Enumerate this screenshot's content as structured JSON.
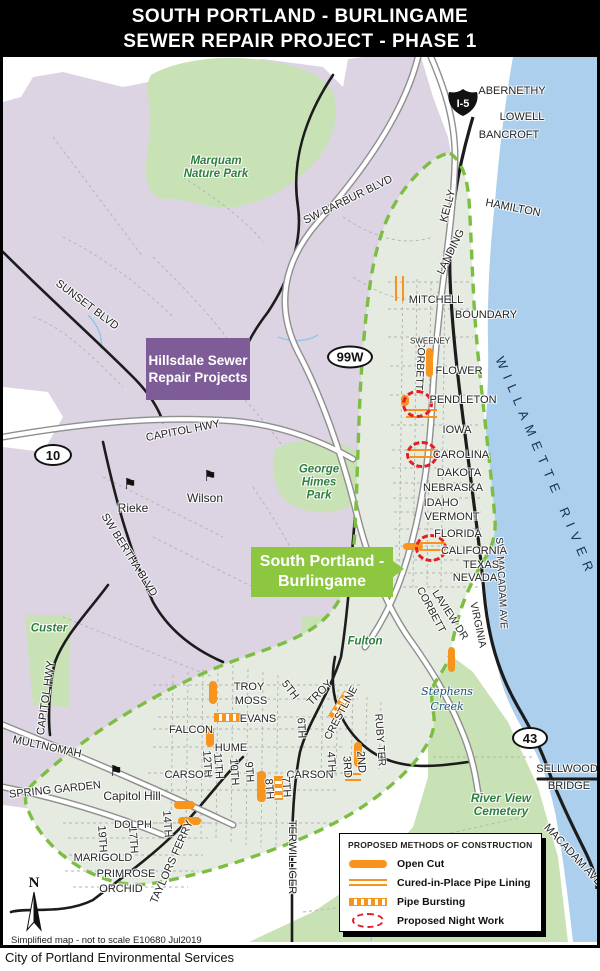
{
  "title": {
    "line1": "SOUTH PORTLAND - BURLINGAME",
    "line2": "SEWER REPAIR PROJECT - PHASE 1"
  },
  "footer": {
    "note": "Simplified map - not to scale E10680 Jul2019",
    "credit": "City of Portland Environmental Services"
  },
  "compass": {
    "north": "N"
  },
  "shields": {
    "i5": "I-5",
    "w99": "99W",
    "h10": "10",
    "h43": "43"
  },
  "boxes": {
    "hillsdale": "Hillsdale Sewer Repair Projects",
    "burlingame": "South Portland - Burlingame"
  },
  "parks": {
    "marquam": "Marquam Nature Park",
    "himes": "George Himes Park",
    "custer": "Custer",
    "fulton": "Fulton",
    "cemetery": "River View Cemetery"
  },
  "water": {
    "river": "WILLAMETTE RIVER",
    "creek": "Stephens Creek"
  },
  "schools": {
    "rieke": "Rieke",
    "wilson": "Wilson",
    "capitol_hill": "Capitol Hill"
  },
  "roads": {
    "barbur": "SW BARBUR BLVD",
    "sunset": "SUNSET BLVD",
    "capitol_upper": "CAPITOL HWY",
    "capitol_left": "CAPITOL HWY",
    "bertha": "SW BERTHA BLVD",
    "multnomah": "MULTNOMAH",
    "spring_garden": "SPRING GARDEN",
    "taylors_ferry": "TAYLORS FERRY",
    "terwilliger": "TERWILLIGER",
    "kelly": "KELLY",
    "landing": "LANDING",
    "macadam_sw": "SW MACADAM AVE",
    "macadam": "MACADAM AVE",
    "sellwood1": "SELLWOOD",
    "sellwood2": "BRIDGE",
    "laview": "LAVIEW DR",
    "virginia": "VIRGINIA",
    "corbett_n": "CORBETT",
    "corbett_s": "CORBETT"
  },
  "streets": {
    "abernethy": "ABERNETHY",
    "lowell": "LOWELL",
    "bancroft": "BANCROFT",
    "hamilton": "HAMILTON",
    "mitchell": "MITCHELL",
    "boundary": "BOUNDARY",
    "sweeney": "SWEENEY",
    "flower": "FLOWER",
    "pendleton": "PENDLETON",
    "iowa": "IOWA",
    "carolina": "CAROLINA",
    "dakota": "DAKOTA",
    "nebraska": "NEBRASKA",
    "idaho": "IDAHO",
    "vermont": "VERMONT",
    "florida": "FLORIDA",
    "california": "CALIFORNIA",
    "texas": "TEXAS",
    "nevada": "NEVADA",
    "troy1": "TROY",
    "moss": "MOSS",
    "evans": "EVANS",
    "falcon": "FALCON",
    "hume": "HUME",
    "carson1": "CARSON",
    "carson2": "CARSON",
    "troy2": "TROY",
    "crestline": "CRESTLINE",
    "ruby": "RUBY TER",
    "dolph": "DOLPH",
    "marigold": "MARIGOLD",
    "primrose": "PRIMROSE",
    "orchid": "ORCHID",
    "s2": "2ND",
    "s3": "3RD",
    "s4": "4TH",
    "s5": "5TH",
    "s6": "6TH",
    "s7": "7TH",
    "s8": "8TH",
    "s9": "9TH",
    "s10": "10TH",
    "s11": "11TH",
    "s12": "12TH",
    "s14": "14TH",
    "s17": "17TH",
    "s19": "19TH"
  },
  "legend": {
    "title": "PROPOSED METHODS OF CONSTRUCTION",
    "open_cut": "Open Cut",
    "cured": "Cured-in-Place Pipe Lining",
    "bursting": "Pipe Bursting",
    "night": "Proposed Night Work"
  },
  "colors": {
    "orange_construction": "#F7941E",
    "night_work_red": "#E31E26",
    "boundary_green": "#7CBE42",
    "project_label_green": "#8DC63F",
    "hillsdale_purple": "#7D5C97",
    "urban_purple": "#DCD3E3",
    "park_green": "#C8E2B6",
    "project_fill": "#E5EBE1",
    "river_blue": "#ABCFEC"
  }
}
